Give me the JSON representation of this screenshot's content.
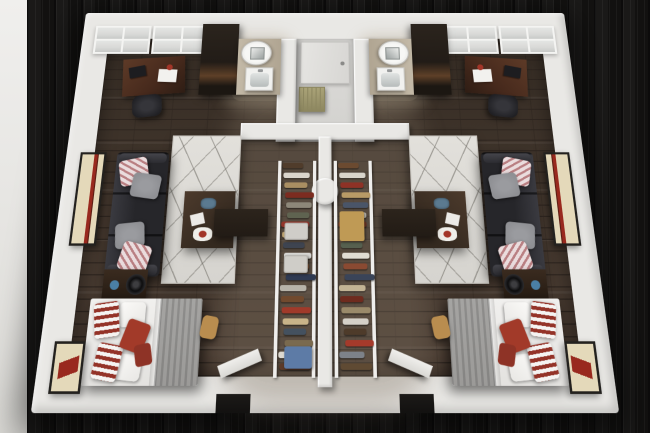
{
  "meta": {
    "description": "3D cutaway floor plan rendering of two mirrored apartment units sharing a central hallway and back-to-back closets",
    "units": 2,
    "layout": "mirrored"
  },
  "theme": {
    "background_wood": "#161514",
    "background_streak": "#0c0b0b",
    "left_strip": "#e8e7e5",
    "wall": "#e9e8e5",
    "wall_shade": "#c7c5c1",
    "floor_base": "#4a3c32",
    "floor_dark": "#2f2620",
    "hall_floor": "#d2d1ce",
    "bath_floor": "#baac94",
    "rug": "#e2e0db",
    "rug_line": "#6e6b64",
    "couch": "#26262a",
    "couch_light": "#3a3a40",
    "pillow_gray": "#8f9094",
    "stripe_white": "#eadcdd",
    "stripe_pink": "#b97f82",
    "table_wood": "#352a20",
    "console_wood": "#221b15",
    "bed_sheet": "#f1f0ee",
    "blanket": "#9b9a98",
    "pillow_red": "#a23a29",
    "stripe_red": "#943328",
    "vanity": "#c3b9a7",
    "cabinet": "#221c17",
    "cabinet_band": "#5e4028",
    "desk_wood": "#46291c",
    "radiator": "#aaa378",
    "radiator_dark": "#8d8760",
    "door": "#e6e5e2",
    "window_glass": "#d8d9d7",
    "window_frame": "#f4f4f2",
    "art_cream": "#e4d9ba",
    "art_red": "#99291e",
    "frame_dark": "#23211e",
    "accent_blue": "#4a7fa5",
    "box_light": "#cfcdc8",
    "box_blue": "#5d7ba6",
    "box_tan": "#bf9a55",
    "tan_item": "#b98d4f",
    "notch_dark": "#121110"
  },
  "windows": {
    "sections_per_unit": 2,
    "panes_per_section": 4,
    "grid": "2x2"
  },
  "radiator": {
    "fins": 6
  },
  "closets": {
    "left_items": [
      "#503c2b",
      "#d9d5cc",
      "#a98e62",
      "#7c2c20",
      "#8d8779",
      "#5f6350",
      "#93352a",
      "#c2a876",
      "#3e4450",
      "#d8d7d4",
      "#8c5a39",
      "#2f3a52",
      "#b7b3a9",
      "#714a2e",
      "#a03a2a",
      "#c9b489",
      "#44515f",
      "#7a6a4f",
      "#ddd9d0",
      "#5c3a28"
    ],
    "right_items": [
      "#6b4a30",
      "#d8d4cb",
      "#8e3226",
      "#b89a66",
      "#4a5568",
      "#cfcbc2",
      "#7a3a28",
      "#a5835a",
      "#56604f",
      "#e0dcd3",
      "#8a4a32",
      "#3a4458",
      "#c2b394",
      "#6e2b1e",
      "#9a8a6a",
      "#d5d1c8",
      "#4e3b2a",
      "#a53a2b",
      "#7d8289",
      "#5f4a33"
    ]
  }
}
